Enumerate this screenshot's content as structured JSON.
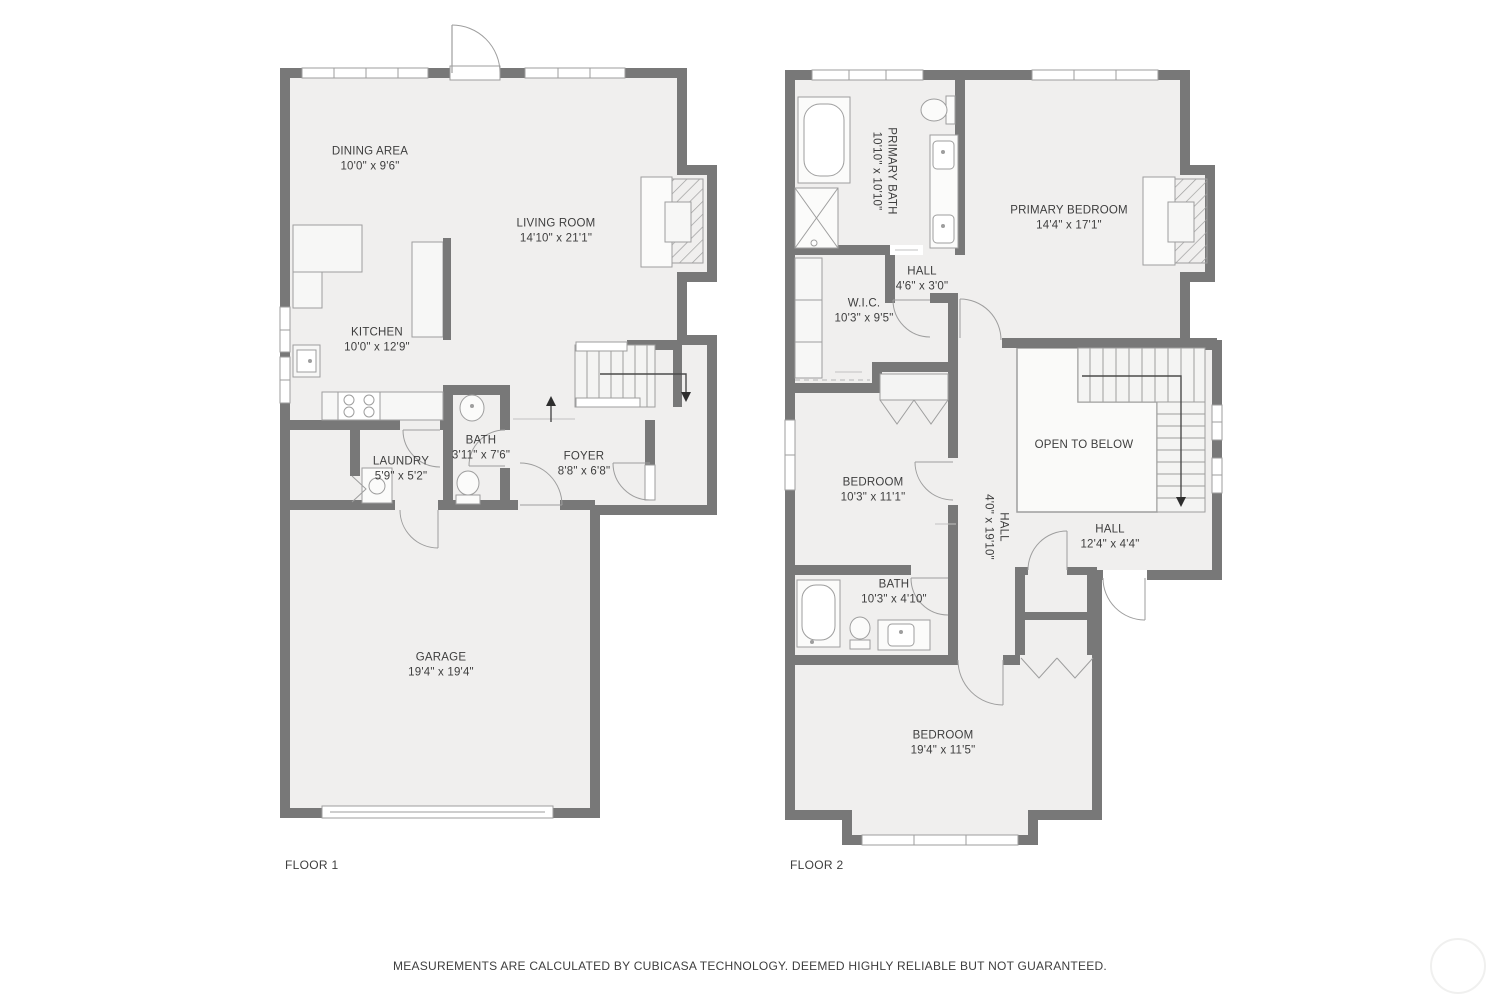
{
  "colors": {
    "wall": "#787878",
    "floor_fill": "#f0efee",
    "fixture_line": "#9e9e9e",
    "label_text": "#3e3e3e",
    "window_fill": "#ffffff"
  },
  "floors": [
    {
      "label": "FLOOR 1",
      "rooms": [
        {
          "name": "DINING AREA",
          "dims": "10'0\" x 9'6\""
        },
        {
          "name": "LIVING ROOM",
          "dims": "14'10\" x 21'1\""
        },
        {
          "name": "KITCHEN",
          "dims": "10'0\" x 12'9\""
        },
        {
          "name": "BATH",
          "dims": "3'11\" x 7'6\""
        },
        {
          "name": "LAUNDRY",
          "dims": "5'9\" x 5'2\""
        },
        {
          "name": "FOYER",
          "dims": "8'8\" x 6'8\""
        },
        {
          "name": "GARAGE",
          "dims": "19'4\" x 19'4\""
        }
      ]
    },
    {
      "label": "FLOOR 2",
      "rooms": [
        {
          "name": "PRIMARY BATH",
          "dims": "10'10\" x 10'10\""
        },
        {
          "name": "PRIMARY BEDROOM",
          "dims": "14'4\" x 17'1\""
        },
        {
          "name": "HALL",
          "dims": "4'6\" x 3'0\""
        },
        {
          "name": "W.I.C.",
          "dims": "10'3\" x 9'5\""
        },
        {
          "name": "BEDROOM",
          "dims": "10'3\" x 11'1\""
        },
        {
          "name": "HALL",
          "dims": "4'0\" x 19'10\""
        },
        {
          "name": "OPEN TO BELOW"
        },
        {
          "name": "HALL",
          "dims": "12'4\" x 4'4\""
        },
        {
          "name": "BATH",
          "dims": "10'3\" x 4'10\""
        },
        {
          "name": "BEDROOM",
          "dims": "19'4\" x 11'5\""
        }
      ]
    }
  ],
  "footer": {
    "disclaimer": "MEASUREMENTS ARE CALCULATED BY CUBICASA TECHNOLOGY. DEEMED HIGHLY RELIABLE BUT NOT GUARANTEED."
  }
}
